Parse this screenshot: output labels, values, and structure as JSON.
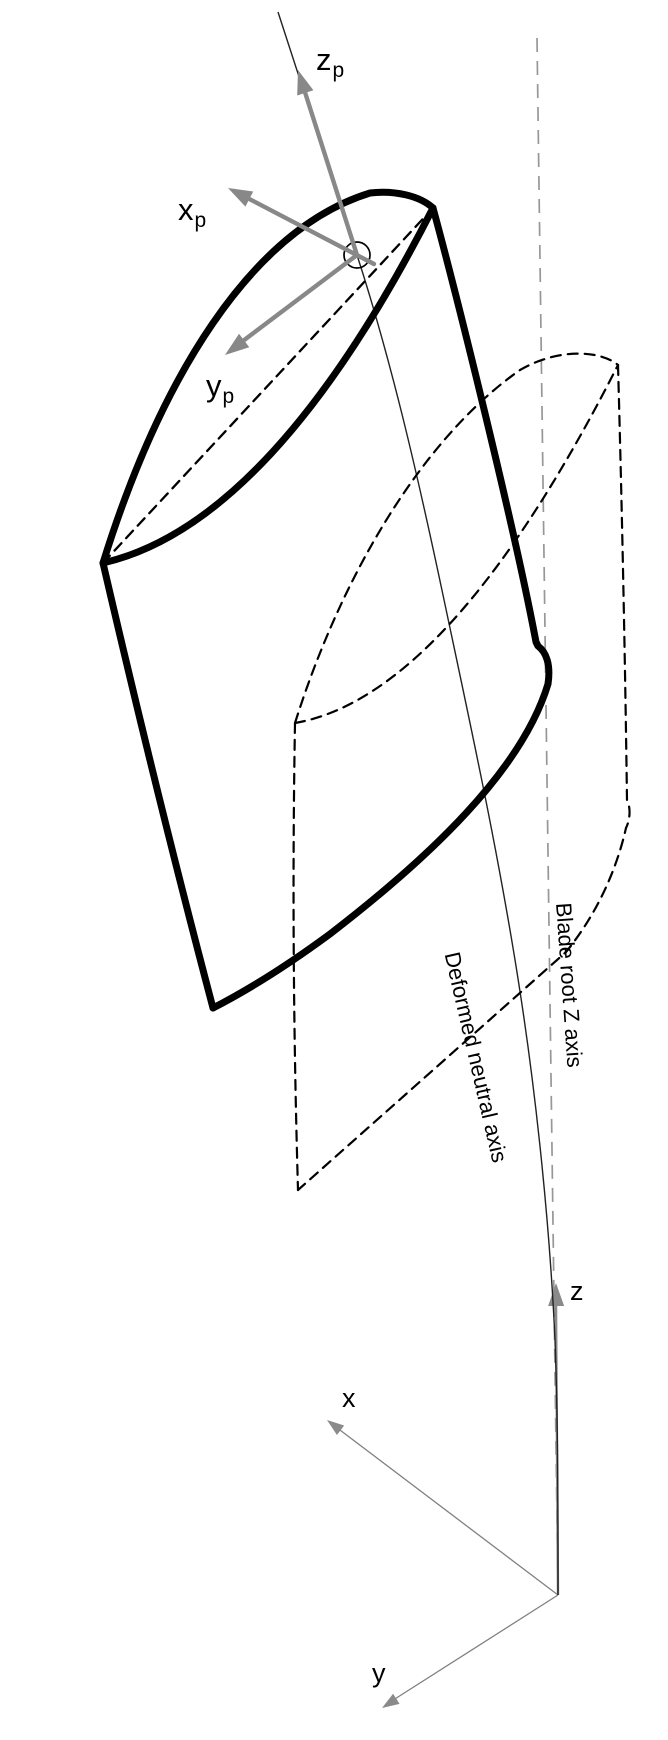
{
  "figure": {
    "description_labels": {
      "deformed_neutral_axis": "Deformed neutral axis",
      "blade_root_z_axis": "Blade root Z axis"
    },
    "principal_frame": {
      "x": {
        "main": "x",
        "sub": "p"
      },
      "y": {
        "main": "y",
        "sub": "p"
      },
      "z": {
        "main": "z",
        "sub": "p"
      }
    },
    "root_frame": {
      "x": "x",
      "y": "y",
      "z": "z"
    },
    "colors": {
      "background": "#ffffff",
      "blade_outline": "#000000",
      "hidden_dashed": "#000000",
      "principal_arrow_gray": "#888888",
      "root_axis_gray": "#979797",
      "neutral_axis_line": "#222222",
      "text": "#000000"
    }
  }
}
